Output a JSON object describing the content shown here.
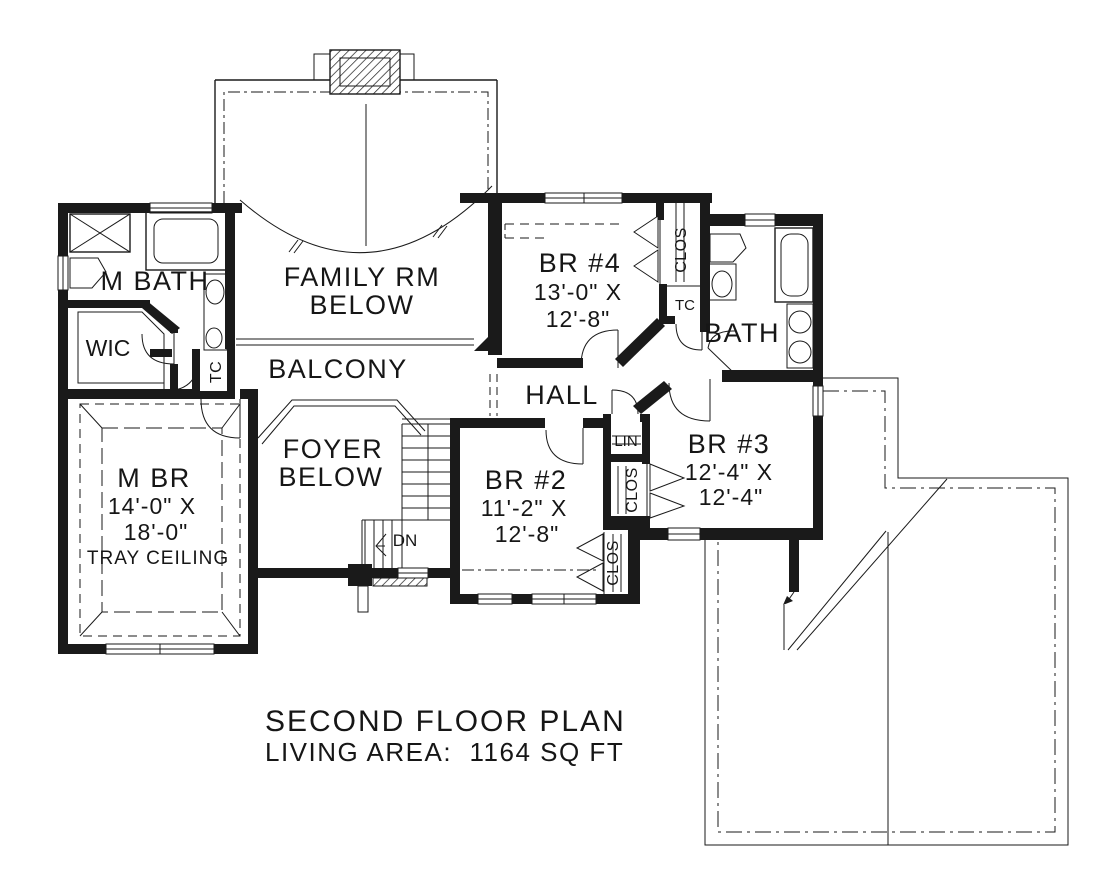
{
  "plan": {
    "title_line1": "SECOND FLOOR PLAN",
    "title_line2": "LIVING AREA:  1164 SQ FT",
    "rooms": {
      "m_bath": "M BATH",
      "wic": "WIC",
      "tc_left": "TC",
      "family_rm_1": "FAMILY RM",
      "family_rm_2": "BELOW",
      "balcony": "BALCONY",
      "br4": "BR #4",
      "br4_dim1": "13'-0\" X",
      "br4_dim2": "12'-8\"",
      "clos_br4": "CLOS",
      "tc_right": "TC",
      "bath": "BATH",
      "hall": "HALL",
      "m_br": "M BR",
      "m_br_dim1": "14'-0\" X",
      "m_br_dim2": "18'-0\"",
      "m_br_note": "TRAY CEILING",
      "foyer_1": "FOYER",
      "foyer_2": "BELOW",
      "stairs_dn": "DN",
      "br2": "BR #2",
      "br2_dim1": "11'-2\" X",
      "br2_dim2": "12'-8\"",
      "lin": "LIN",
      "clos_br3": "CLOS",
      "clos_br2": "CLOS",
      "br3": "BR #3",
      "br3_dim1": "12'-4\" X",
      "br3_dim2": "12'-4\""
    },
    "colors": {
      "ink": "#1a1a1a",
      "paper": "#ffffff"
    }
  }
}
